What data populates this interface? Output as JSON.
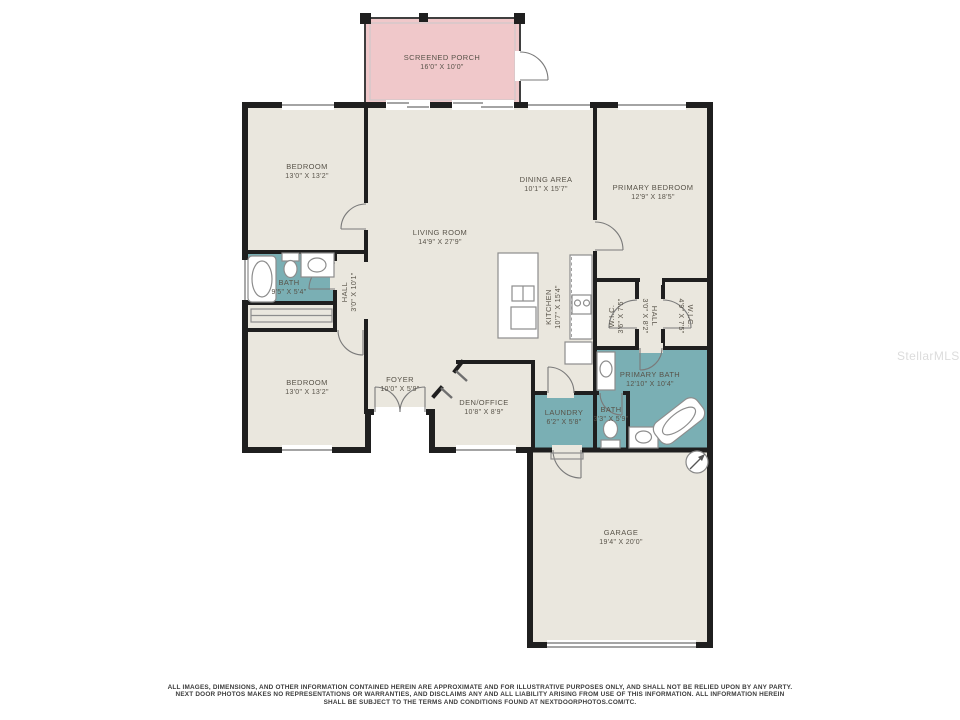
{
  "watermark": "StellarMLS",
  "colors": {
    "walls": "#1f1f1f",
    "floor": "#eae7de",
    "wet": "#7aafb4",
    "porch": "#f0c8ca"
  },
  "rooms": {
    "screened_porch": {
      "name": "SCREENED PORCH",
      "dims": "16'0\" X 10'0\""
    },
    "bedroom_top": {
      "name": "BEDROOM",
      "dims": "13'0\" X 13'2\""
    },
    "dining_area": {
      "name": "DINING AREA",
      "dims": "10'1\" X 15'7\""
    },
    "primary_bedroom": {
      "name": "PRIMARY BEDROOM",
      "dims": "12'9\" X 18'5\""
    },
    "living_room": {
      "name": "LIVING ROOM",
      "dims": "14'9\" X 27'9\""
    },
    "bath_hall": {
      "name": "BATH",
      "dims": "9'5\" X 5'4\""
    },
    "hall_west": {
      "name": "HALL",
      "dims": "3'0\" X 10'1\""
    },
    "kitchen": {
      "name": "KITCHEN",
      "dims": "10'7\" X 15'4\""
    },
    "wic_left": {
      "name": "W.I.C.",
      "dims": "3'6\" X 7'5\""
    },
    "hall_east": {
      "name": "HALL",
      "dims": "3'0\" X 8'2\""
    },
    "wic_right": {
      "name": "W.I.C.",
      "dims": "4'9\" X 7'5\""
    },
    "bedroom_bottom": {
      "name": "BEDROOM",
      "dims": "13'0\" X 13'2\""
    },
    "foyer": {
      "name": "FOYER",
      "dims": "10'0\" X 5'9\""
    },
    "den_office": {
      "name": "DEN/OFFICE",
      "dims": "10'8\" X 8'9\""
    },
    "primary_bath": {
      "name": "PRIMARY BATH",
      "dims": "12'10\" X 10'4\""
    },
    "laundry": {
      "name": "LAUNDRY",
      "dims": "6'2\" X 5'8\""
    },
    "bath_small": {
      "name": "BATH",
      "dims": "3'3\" X 5'9\""
    },
    "garage": {
      "name": "GARAGE",
      "dims": "19'4\" X 20'0\""
    }
  },
  "disclaimer": {
    "line1": "ALL IMAGES, DIMENSIONS, AND OTHER INFORMATION CONTAINED HEREIN ARE APPROXIMATE AND FOR ILLUSTRATIVE PURPOSES ONLY, AND SHALL NOT BE RELIED UPON BY ANY PARTY.",
    "line2": "NEXT DOOR PHOTOS MAKES NO REPRESENTATIONS OR WARRANTIES, AND DISCLAIMS ANY AND ALL LIABILITY ARISING FROM USE OF THIS INFORMATION. ALL INFORMATION HEREIN",
    "line3": "SHALL BE SUBJECT TO THE TERMS AND CONDITIONS FOUND AT NEXTDOORPHOTOS.COM/TC."
  }
}
